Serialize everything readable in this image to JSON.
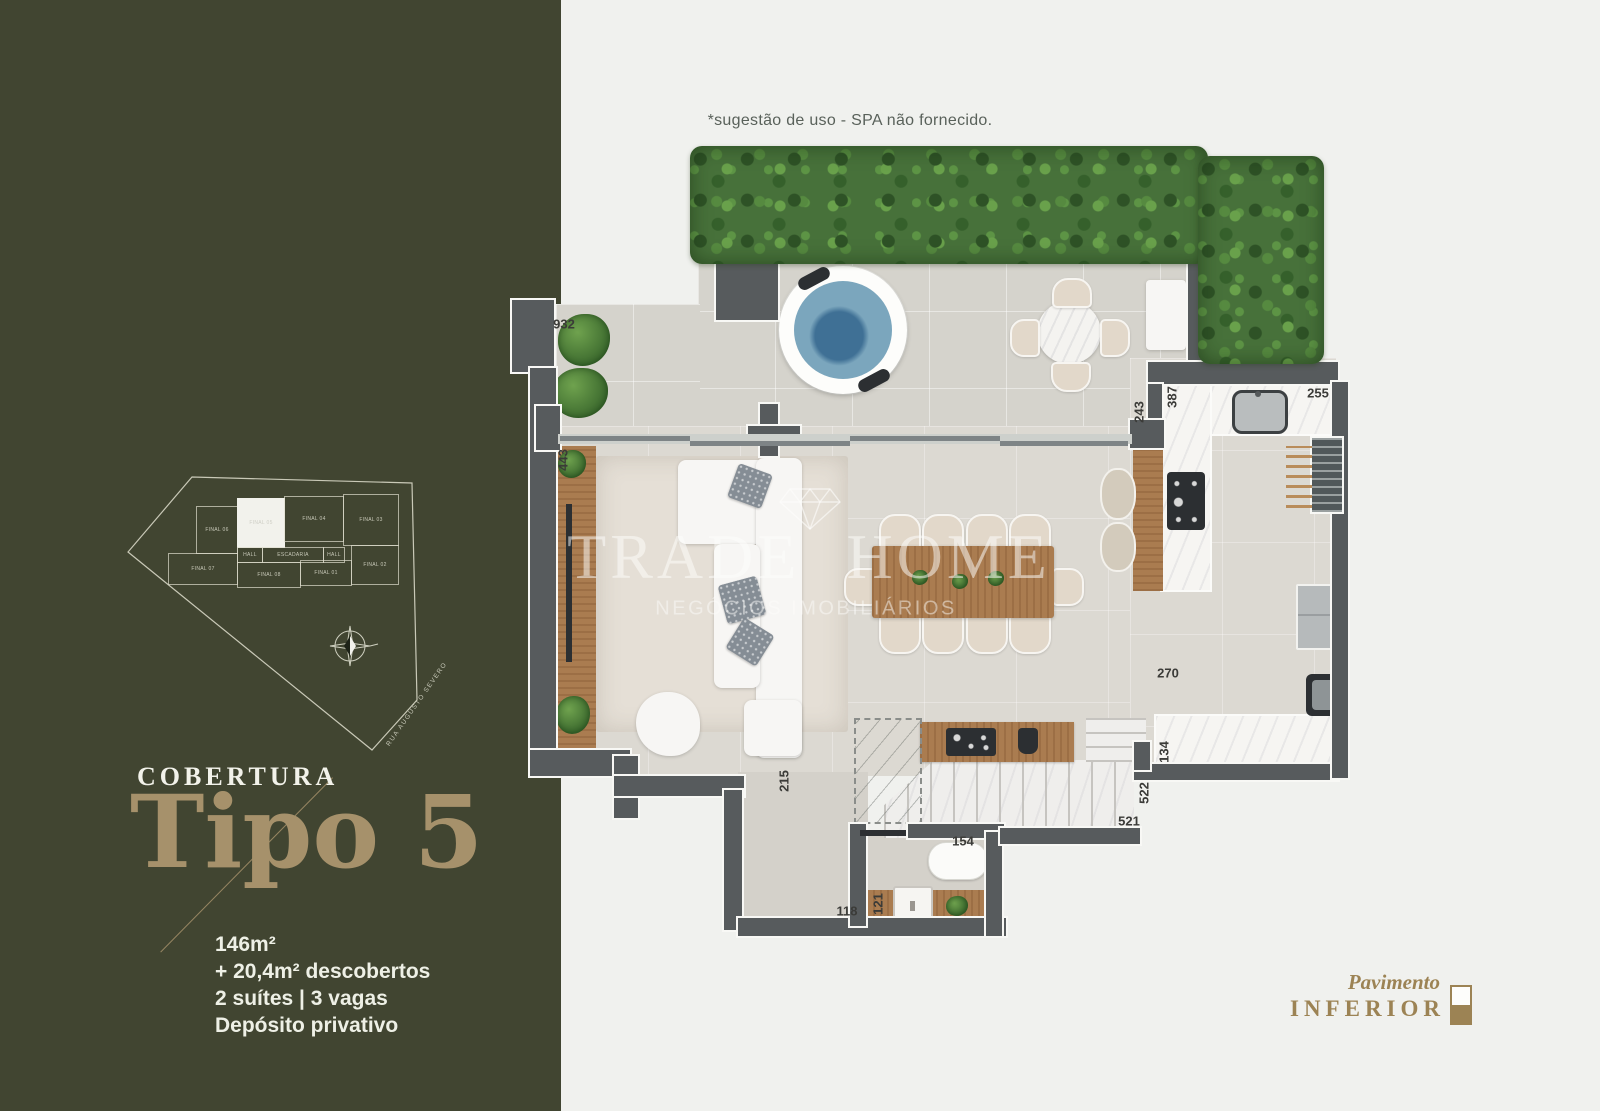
{
  "palette": {
    "sidebar_bg": "#414531",
    "gold": "#a6916b",
    "page_bg": "#f0f1ee",
    "wall": "#575b5d",
    "wood": "#aa7c50",
    "hedge": "#47713a",
    "spa_water": "#7ba6bd",
    "indicator_gold": "#9c8354"
  },
  "sidebar": {
    "category_label": "COBERTURA",
    "type_label": "Tipo 5",
    "specs": [
      "146m²",
      "+ 20,4m² descobertos",
      "2 suítes | 3 vagas",
      "Depósito privativo"
    ],
    "key_plan": {
      "street_label": "RUA AUGUSTO SEVERO",
      "highlighted_unit": "FINAL 05",
      "compass_icon": "compass-rose",
      "units": [
        {
          "label": "FINAL 06"
        },
        {
          "label": "FINAL 05"
        },
        {
          "label": "FINAL 04"
        },
        {
          "label": "FINAL 03"
        },
        {
          "label": "HALL"
        },
        {
          "label": "ESCADARIA"
        },
        {
          "label": "HALL"
        },
        {
          "label": "FINAL 07"
        },
        {
          "label": "FINAL 08"
        },
        {
          "label": "FINAL 01"
        },
        {
          "label": "FINAL 02"
        }
      ]
    }
  },
  "plan": {
    "note": "*sugestão de uso - SPA não fornecido.",
    "measurements": [
      "932",
      "443",
      "243",
      "387",
      "255",
      "270",
      "134",
      "522",
      "521",
      "154",
      "121",
      "118",
      "215"
    ]
  },
  "watermark": {
    "brand": "TRADE HOME",
    "tagline": "NEGÓCIOS IMOBILIÁRIOS",
    "diamond_icon": "diamond"
  },
  "floor_indicator": {
    "line1": "Pavimento",
    "line2": "INFERIOR",
    "icon": "lower-floor-indicator"
  }
}
